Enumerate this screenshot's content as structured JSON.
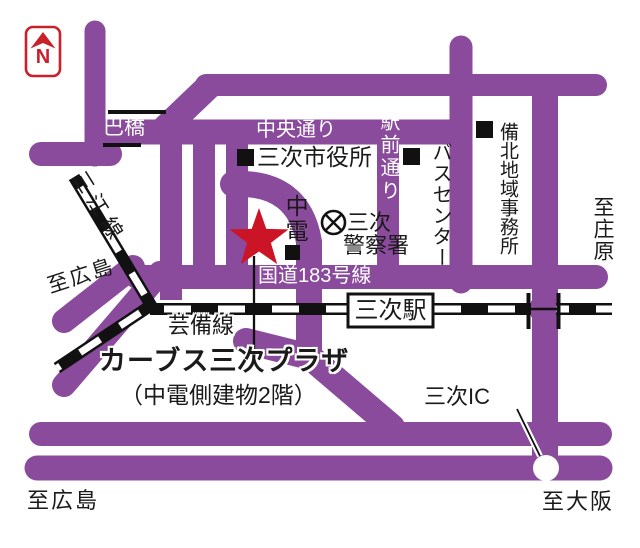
{
  "labels": {
    "north": "N",
    "tomoe_bridge": "巴橋",
    "chuo_dori": "中央通り",
    "city_hall": "三次市役所",
    "ekimae_dori": "駅前通り",
    "bus_center": "バスセンター",
    "bihoku_office": "備北地域事務所",
    "to_shobara": "至庄原",
    "sanko_line": "三江線",
    "to_hiroshima_west": "至広島",
    "chuden": "中電",
    "police_line1": "三次",
    "police_line2": "警察署",
    "route183": "国道183号線",
    "miyoshi_station": "三次駅",
    "geibi_line": "芸備線",
    "destination_name": "カーブス三次プラザ",
    "destination_note": "（中電側建物2階）",
    "miyoshi_ic": "三次IC",
    "to_osaka": "至大阪",
    "to_hiroshima_south": "至広島"
  },
  "colors": {
    "road_purple": "#8a4b9c",
    "marker_red": "#cb1526",
    "north_red": "#c9202a",
    "rail_black": "#111111"
  }
}
